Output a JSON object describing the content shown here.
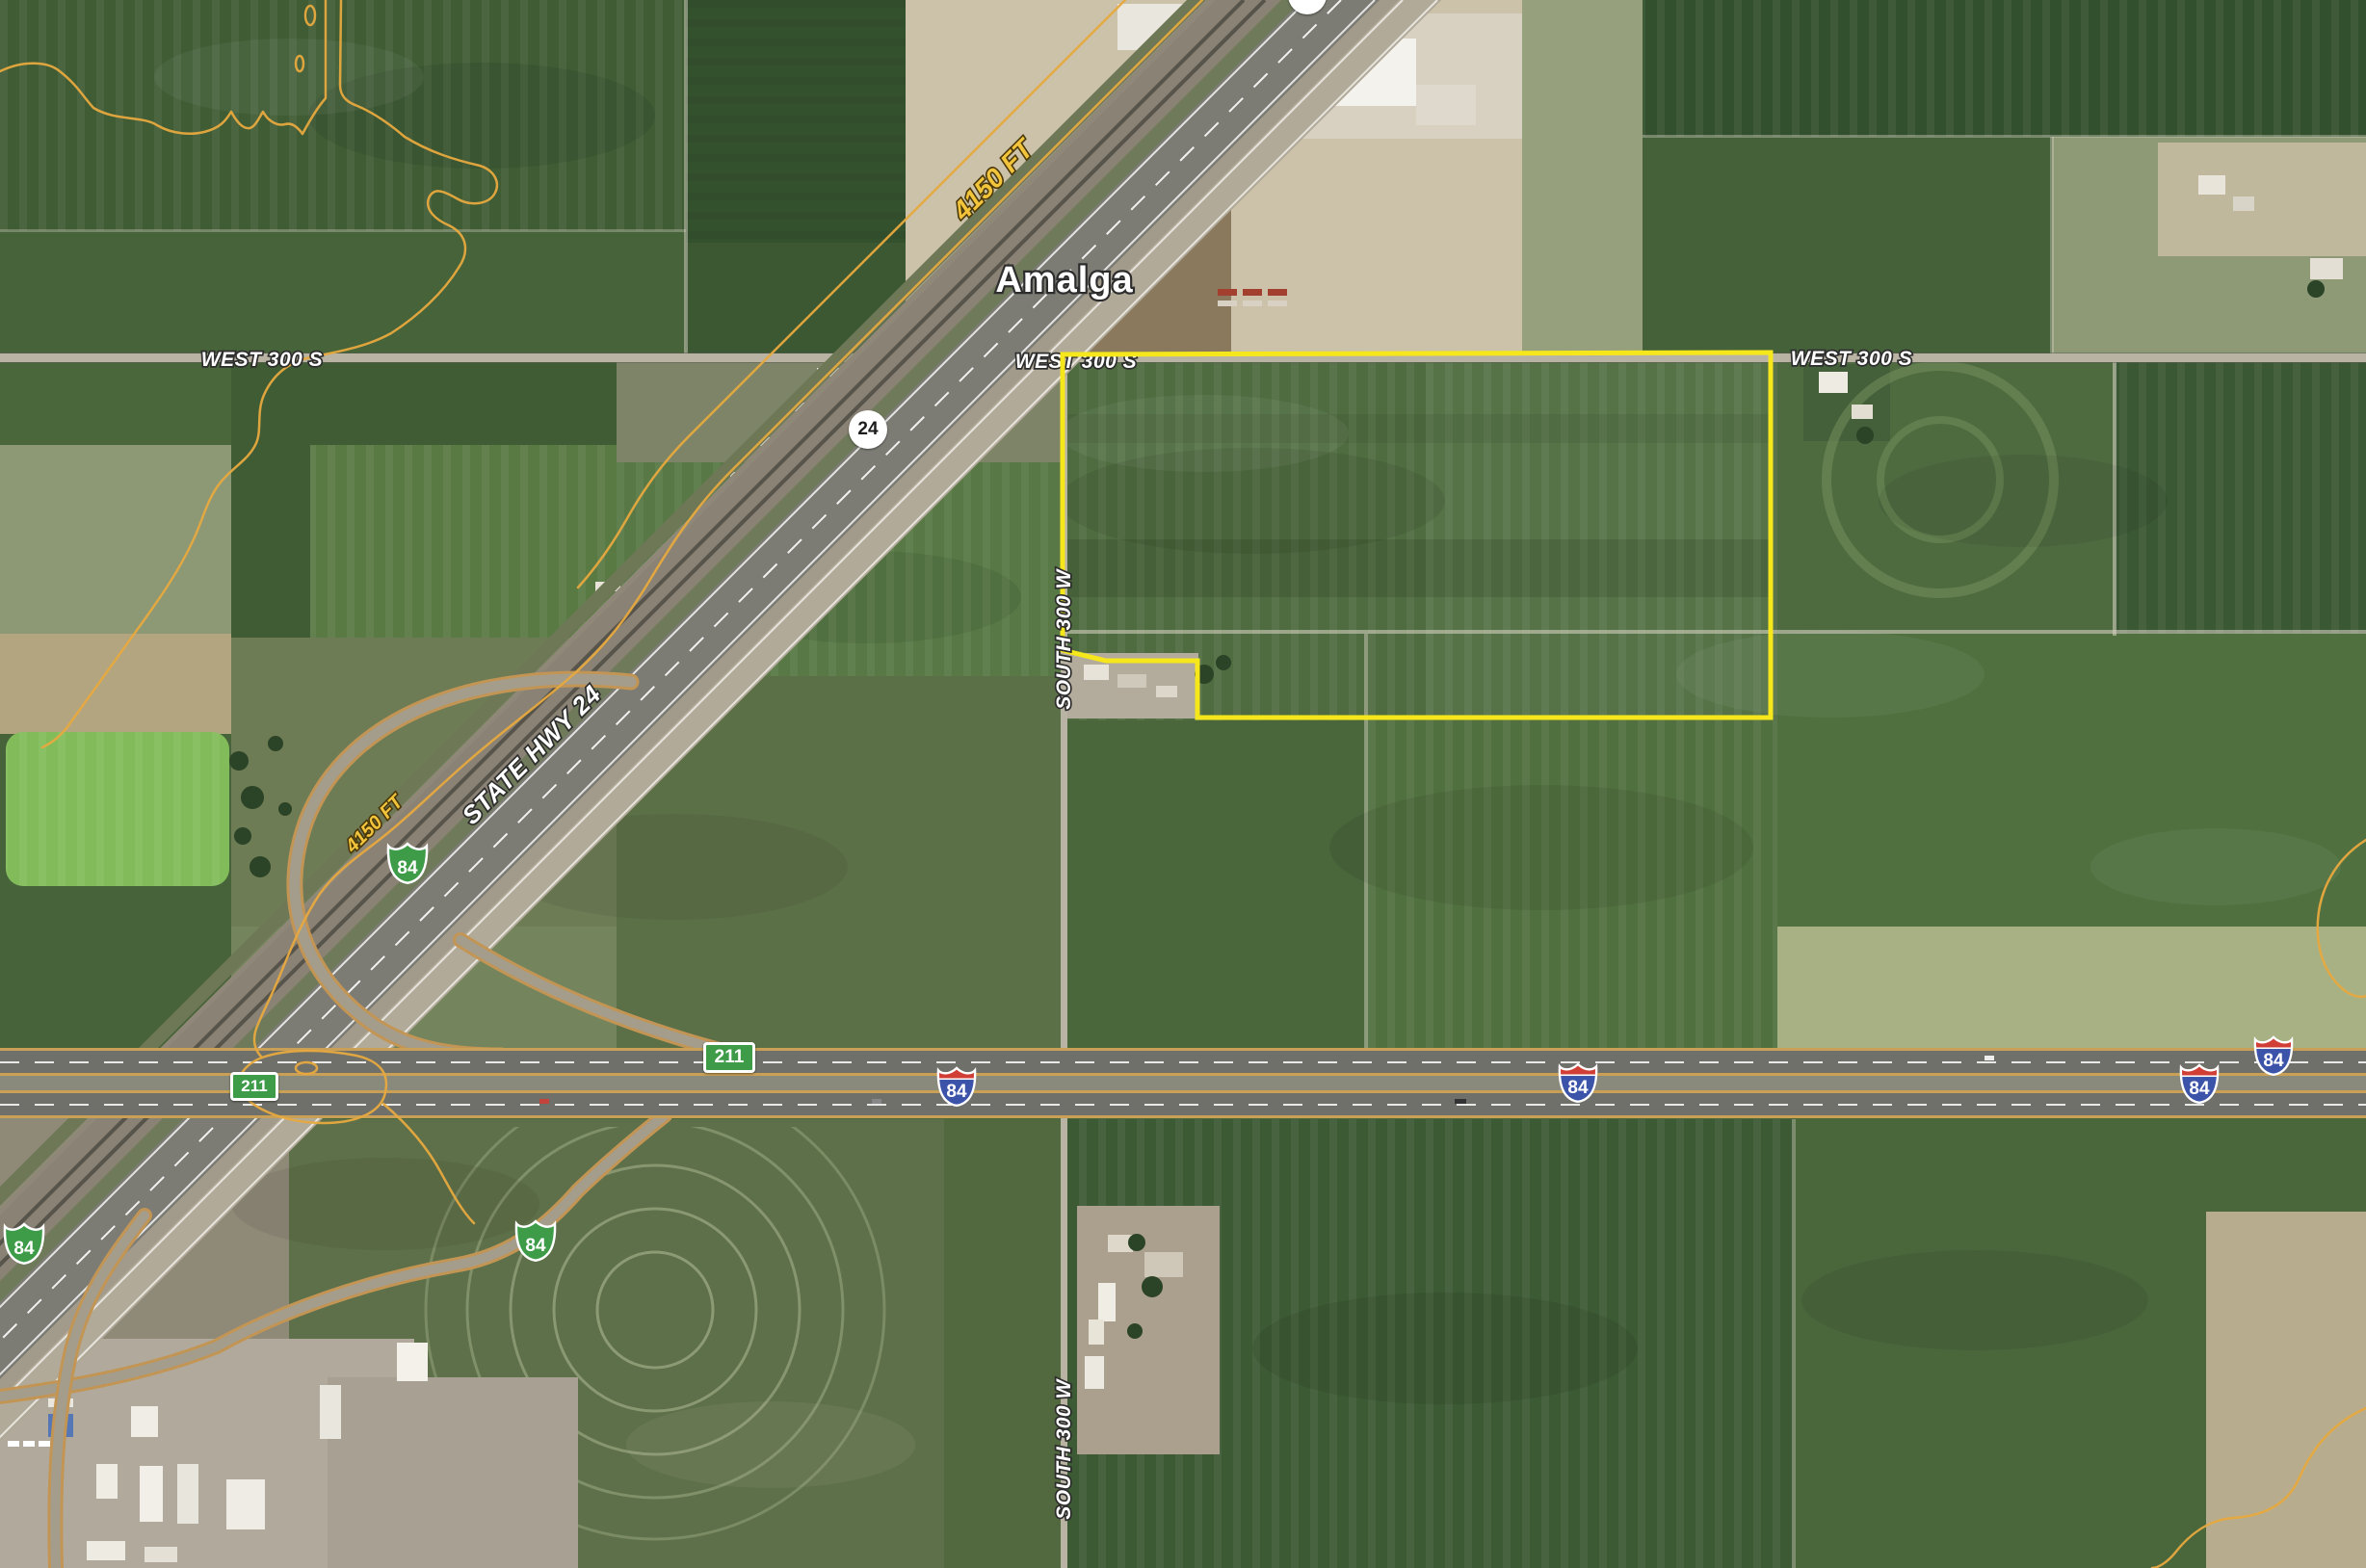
{
  "labels": {
    "town": "Amalga"
  },
  "roads": {
    "west_300_s": "WEST 300 S",
    "south_300_w": "SOUTH 300 W",
    "state_hwy_24": "STATE HWY 24"
  },
  "contours": {
    "elevation_label": "4150 FT",
    "color": "#E7A93F"
  },
  "shields": {
    "interstate": "84",
    "business_loop": "84",
    "state_route": "24",
    "local_route": "211"
  },
  "parcel": {
    "outline_color": "#F6E71C"
  },
  "colors": {
    "interstate_blue": "#3B53A8",
    "interstate_red": "#D03E36",
    "route_green": "#3E9C49",
    "field_green": "#47633A",
    "freeway_edge": "#C9A055"
  }
}
